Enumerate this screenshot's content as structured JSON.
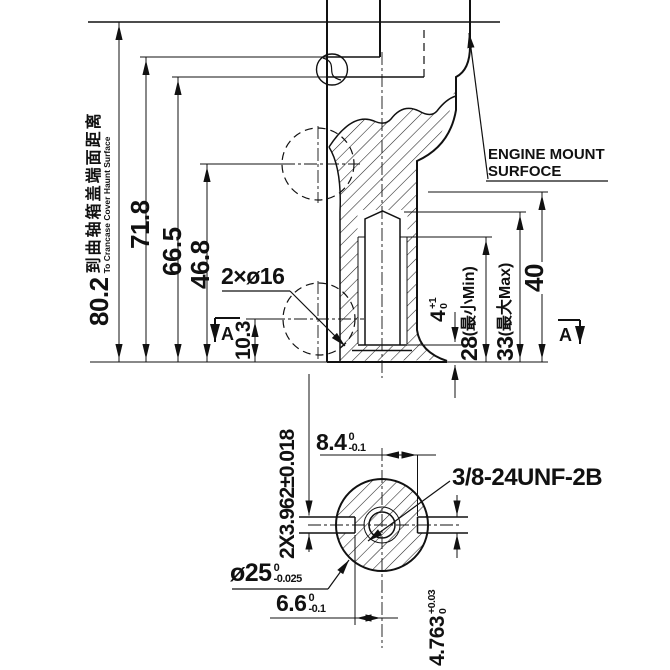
{
  "upper_view": {
    "left_note": {
      "value": "80.2",
      "zh": "到曲轴箱盖端面距离",
      "en": "To Crancase Cover Haunt Surface"
    },
    "dims": {
      "h71": "71.8",
      "h66": "66.5",
      "h46": "46.8",
      "h10": "10.3"
    },
    "holes_label": "2×ø16",
    "engine_mount": {
      "line1": "ENGINE MOUNT",
      "line2": "SURFOCE"
    },
    "right_dims": {
      "d28": "28",
      "d28_note": "(最小Min)",
      "d33": "33",
      "d33_note": "(最大Max)",
      "d40": "40",
      "d4": "4",
      "d4_up": "+1",
      "d4_dn": "0"
    },
    "section_marker": "A"
  },
  "section_view": {
    "slot_width": "2X3.962±0.018",
    "d84": "8.4",
    "d84_up": "0",
    "d84_dn": "-0.1",
    "thread_spec": "3/8-24UNF-2B",
    "d25": "ø25",
    "d25_up": "0",
    "d25_dn": "-0.025",
    "d66": "6.6",
    "d66_up": "0",
    "d66_dn": "-0.1",
    "d4763": "4.763",
    "d4763_up": "+0.03",
    "d4763_dn": "0"
  }
}
